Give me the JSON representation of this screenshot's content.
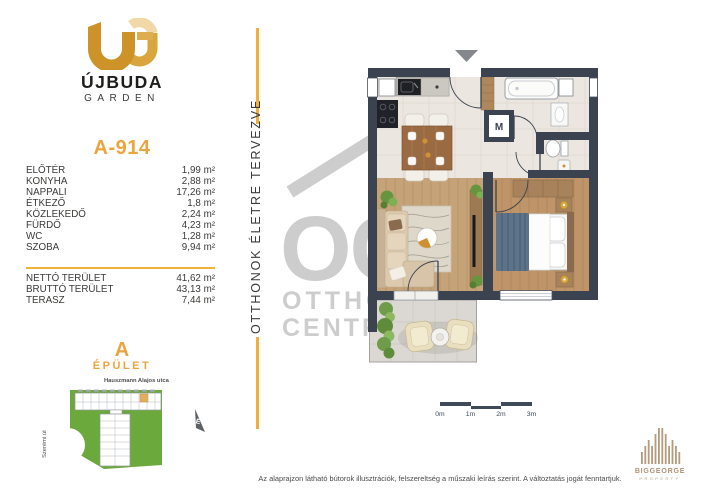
{
  "brand": {
    "logo_top": "ÚJBUDA",
    "logo_bottom": "GARDEN"
  },
  "unit": {
    "id": "A-914"
  },
  "rooms": [
    {
      "label": "ELŐTÉR",
      "value": "1,99 m²"
    },
    {
      "label": "KONYHA",
      "value": "2,88 m²"
    },
    {
      "label": "NAPPALI",
      "value": "17,26 m²"
    },
    {
      "label": "ÉTKEZŐ",
      "value": "1,8 m²"
    },
    {
      "label": "KÖZLEKEDŐ",
      "value": "2,24 m²"
    },
    {
      "label": "FÜRDŐ",
      "value": "4,23 m²"
    },
    {
      "label": "WC",
      "value": "1,28 m²"
    },
    {
      "label": "SZOBA",
      "value": "9,94 m²"
    }
  ],
  "totals": [
    {
      "label": "NETTÓ TERÜLET",
      "value": "41,62 m²"
    },
    {
      "label": "BRUTTÓ TERÜLET",
      "value": "43,13 m²"
    },
    {
      "label": "TERASZ",
      "value": "7,44 m²"
    }
  ],
  "building": {
    "letter": "A",
    "label": "ÉPÜLET",
    "street_top": "Hauszmann Alajos utca",
    "street_left": "Szerémi út",
    "north": "É"
  },
  "tagline": "OTTHONOK ÉLETRE TERVEZVE",
  "floorplan": {
    "shaft": "M"
  },
  "scalebar": {
    "labels": [
      "0m",
      "1m",
      "2m",
      "3m"
    ]
  },
  "watermark": {
    "monogram": "OC",
    "line1": "OTTHON",
    "line2": "CENTRUM"
  },
  "footer": {
    "disclaimer": "Az alaprajzon látható bútorok illusztrációk, felszereltség a műszaki leírás szerint. A változtatás jogát fenntartjuk."
  },
  "developer": {
    "name": "BIGGEORGE",
    "tag": "PROPERTY"
  },
  "colors": {
    "accent": "#ECA43D",
    "wall": "#3B4350",
    "map_green": "#6CA93D",
    "developer_tan": "#B29877"
  }
}
